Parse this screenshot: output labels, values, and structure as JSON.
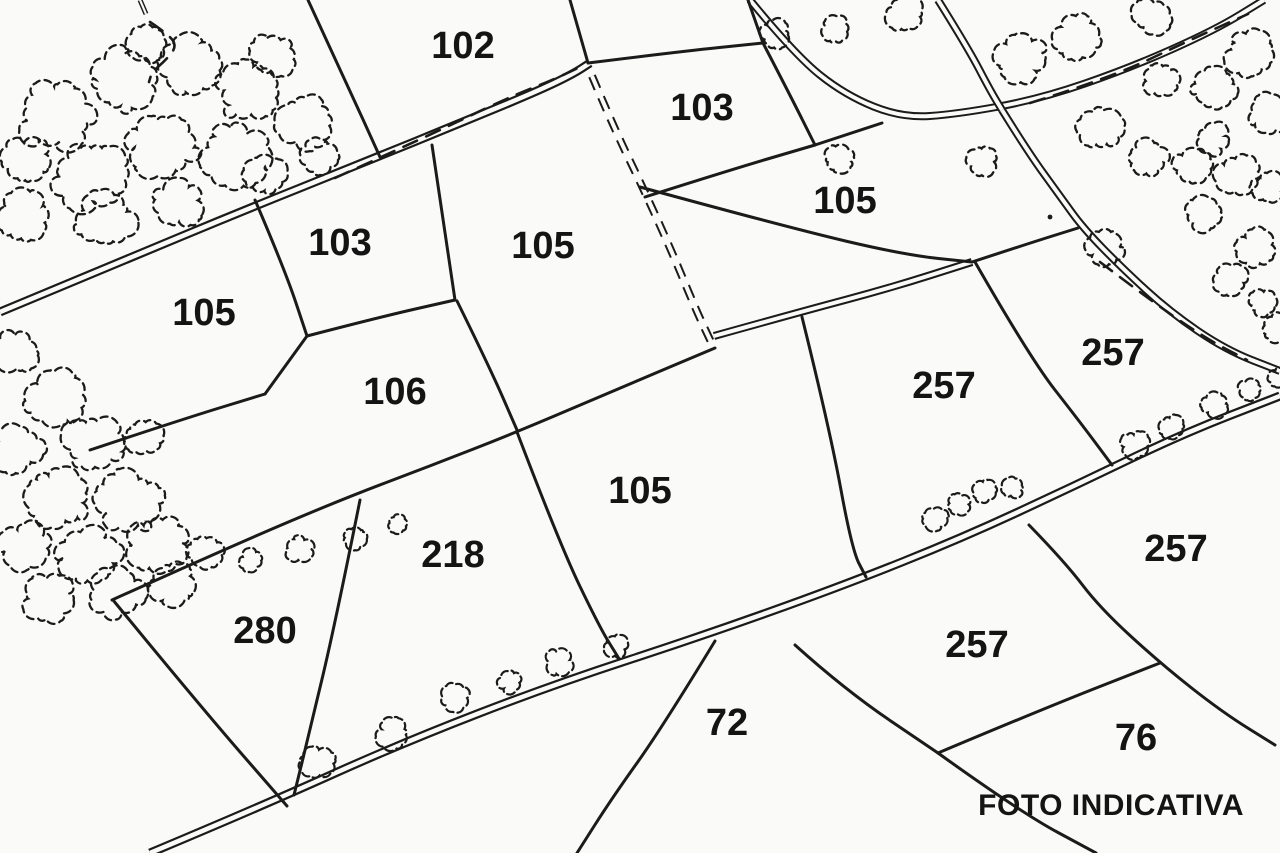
{
  "caption": {
    "text": "FOTO INDICATIVA",
    "x": 1245,
    "y": 822
  },
  "map": {
    "background": "#fafaf9",
    "ink": "#1b1b1b",
    "label_color": "#141414",
    "parcel_labels": [
      {
        "label": "102",
        "x": 463,
        "y": 45
      },
      {
        "label": "103",
        "x": 702,
        "y": 107
      },
      {
        "label": "105",
        "x": 845,
        "y": 200
      },
      {
        "label": "103",
        "x": 340,
        "y": 242
      },
      {
        "label": "105",
        "x": 543,
        "y": 245
      },
      {
        "label": "105",
        "x": 204,
        "y": 312
      },
      {
        "label": "257",
        "x": 1113,
        "y": 352
      },
      {
        "label": "257",
        "x": 944,
        "y": 385
      },
      {
        "label": "106",
        "x": 395,
        "y": 391
      },
      {
        "label": "105",
        "x": 640,
        "y": 490
      },
      {
        "label": "257",
        "x": 1176,
        "y": 548
      },
      {
        "label": "218",
        "x": 453,
        "y": 554
      },
      {
        "label": "280",
        "x": 265,
        "y": 630
      },
      {
        "label": "257",
        "x": 977,
        "y": 644
      },
      {
        "label": "72",
        "x": 727,
        "y": 722
      },
      {
        "label": "76",
        "x": 1136,
        "y": 737
      }
    ],
    "roads": [
      {
        "name": "road-upper-left",
        "outer": 9,
        "inner": 4.5,
        "points": [
          [
            0,
            312
          ],
          [
            120,
            262
          ],
          [
            240,
            212
          ],
          [
            360,
            164
          ],
          [
            468,
            120
          ],
          [
            540,
            90
          ],
          [
            573,
            74
          ],
          [
            590,
            63
          ]
        ]
      },
      {
        "name": "road-bottom",
        "outer": 9,
        "inner": 4.5,
        "points": [
          [
            150,
            853
          ],
          [
            262,
            806
          ],
          [
            402,
            743
          ],
          [
            552,
            685
          ],
          [
            702,
            636
          ],
          [
            842,
            586
          ],
          [
            962,
            538
          ],
          [
            1072,
            487
          ],
          [
            1182,
            434
          ],
          [
            1280,
            396
          ]
        ]
      },
      {
        "name": "road-top-branch",
        "outer": 8,
        "inner": 4,
        "points": [
          [
            750,
            0
          ],
          [
            795,
            55
          ],
          [
            845,
            95
          ],
          [
            902,
            118
          ],
          [
            958,
            114
          ],
          [
            1040,
            99
          ],
          [
            1130,
            68
          ],
          [
            1215,
            30
          ],
          [
            1264,
            0
          ]
        ]
      },
      {
        "name": "road-top-spur",
        "outer": 8,
        "inner": 4,
        "points": [
          [
            938,
            0
          ],
          [
            968,
            48
          ],
          [
            990,
            90
          ],
          [
            1002,
            110
          ]
        ]
      },
      {
        "name": "road-right",
        "outer": 8,
        "inner": 4,
        "points": [
          [
            1002,
            110
          ],
          [
            1028,
            152
          ],
          [
            1060,
            196
          ],
          [
            1083,
            228
          ],
          [
            1122,
            268
          ],
          [
            1170,
            312
          ],
          [
            1226,
            350
          ],
          [
            1280,
            371
          ]
        ]
      },
      {
        "name": "field-track-solid",
        "outer": 8,
        "inner": 4,
        "points": [
          [
            714,
            336
          ],
          [
            800,
            312
          ],
          [
            890,
            288
          ],
          [
            972,
            262
          ]
        ]
      },
      {
        "name": "path-stub-top-left",
        "outer": 5,
        "inner": 2.2,
        "points": [
          [
            140,
            0
          ],
          [
            146,
            14
          ]
        ]
      }
    ],
    "dashed_double_tracks": [
      {
        "name": "field-track-dashed",
        "points": [
          [
            592,
            76
          ],
          [
            614,
            128
          ],
          [
            644,
            190
          ],
          [
            672,
            252
          ],
          [
            696,
            310
          ],
          [
            712,
            344
          ]
        ]
      }
    ],
    "boundaries": [
      [
        [
          308,
          0
        ],
        [
          346,
          82
        ],
        [
          380,
          157
        ]
      ],
      [
        [
          570,
          0
        ],
        [
          588,
          63
        ]
      ],
      [
        [
          588,
          63
        ],
        [
          676,
          52
        ],
        [
          763,
          43
        ]
      ],
      [
        [
          748,
          0
        ],
        [
          763,
          43
        ]
      ],
      [
        [
          763,
          43
        ],
        [
          790,
          95
        ],
        [
          815,
          145
        ]
      ],
      [
        [
          645,
          197
        ],
        [
          730,
          170
        ],
        [
          815,
          145
        ]
      ],
      [
        [
          815,
          145
        ],
        [
          882,
          123
        ]
      ],
      [
        [
          640,
          187
        ],
        [
          790,
          228
        ],
        [
          905,
          255
        ],
        [
          972,
          262
        ]
      ],
      [
        [
          972,
          262
        ],
        [
          1030,
          243
        ],
        [
          1078,
          228
        ]
      ],
      [
        [
          255,
          200
        ],
        [
          285,
          270
        ],
        [
          307,
          336
        ]
      ],
      [
        [
          307,
          336
        ],
        [
          380,
          317
        ],
        [
          455,
          300
        ]
      ],
      [
        [
          432,
          145
        ],
        [
          455,
          300
        ]
      ],
      [
        [
          457,
          301
        ],
        [
          490,
          368
        ],
        [
          517,
          430
        ]
      ],
      [
        [
          90,
          450
        ],
        [
          180,
          420
        ],
        [
          265,
          394
        ]
      ],
      [
        [
          265,
          394
        ],
        [
          307,
          336
        ]
      ],
      [
        [
          112,
          600
        ],
        [
          225,
          549
        ],
        [
          340,
          500
        ],
        [
          430,
          466
        ],
        [
          517,
          432
        ],
        [
          620,
          388
        ],
        [
          715,
          348
        ]
      ],
      [
        [
          517,
          432
        ],
        [
          560,
          545
        ],
        [
          600,
          628
        ],
        [
          618,
          657
        ]
      ],
      [
        [
          360,
          500
        ],
        [
          336,
          620
        ],
        [
          310,
          730
        ],
        [
          294,
          795
        ]
      ],
      [
        [
          113,
          600
        ],
        [
          200,
          706
        ],
        [
          287,
          806
        ]
      ],
      [
        [
          802,
          317
        ],
        [
          830,
          430
        ],
        [
          852,
          550
        ],
        [
          866,
          577
        ]
      ],
      [
        [
          975,
          262
        ],
        [
          1030,
          358
        ],
        [
          1080,
          422
        ],
        [
          1112,
          465
        ]
      ],
      [
        [
          1029,
          525
        ],
        [
          1065,
          562
        ],
        [
          1100,
          608
        ],
        [
          1160,
          663
        ],
        [
          1222,
          712
        ],
        [
          1275,
          745
        ]
      ],
      [
        [
          795,
          645
        ],
        [
          845,
          690
        ],
        [
          938,
          753
        ]
      ],
      [
        [
          938,
          753
        ],
        [
          1045,
          708
        ],
        [
          1160,
          663
        ]
      ],
      [
        [
          938,
          753
        ],
        [
          1020,
          812
        ],
        [
          1096,
          853
        ]
      ],
      [
        [
          715,
          641
        ],
        [
          662,
          728
        ],
        [
          612,
          798
        ],
        [
          577,
          853
        ]
      ]
    ],
    "dashed_lines": [
      [
        [
          335,
          178
        ],
        [
          430,
          135
        ],
        [
          505,
          99
        ],
        [
          555,
          79
        ],
        [
          582,
          66
        ]
      ],
      [
        [
          1030,
          103
        ],
        [
          1110,
          78
        ],
        [
          1190,
          40
        ],
        [
          1248,
          14
        ]
      ],
      [
        [
          1100,
          262
        ],
        [
          1150,
          300
        ],
        [
          1205,
          338
        ],
        [
          1247,
          360
        ]
      ],
      [
        [
          150,
          22
        ],
        [
          168,
          34
        ],
        [
          177,
          46
        ],
        [
          166,
          60
        ],
        [
          152,
          72
        ],
        [
          149,
          82
        ]
      ]
    ],
    "trees": [
      [
        55,
        115,
        40
      ],
      [
        122,
        80,
        36
      ],
      [
        190,
        64,
        33
      ],
      [
        250,
        90,
        36
      ],
      [
        305,
        124,
        30
      ],
      [
        90,
        175,
        40
      ],
      [
        163,
        145,
        38
      ],
      [
        235,
        155,
        36
      ],
      [
        25,
        215,
        28
      ],
      [
        105,
        220,
        32
      ],
      [
        178,
        204,
        27
      ],
      [
        265,
        175,
        22
      ],
      [
        318,
        156,
        20
      ],
      [
        28,
        160,
        26
      ],
      [
        272,
        55,
        24
      ],
      [
        148,
        45,
        20
      ],
      [
        15,
        352,
        24
      ],
      [
        55,
        398,
        32
      ],
      [
        18,
        448,
        28
      ],
      [
        95,
        443,
        34
      ],
      [
        58,
        498,
        34
      ],
      [
        130,
        502,
        36
      ],
      [
        25,
        545,
        26
      ],
      [
        90,
        558,
        34
      ],
      [
        158,
        543,
        32
      ],
      [
        50,
        598,
        28
      ],
      [
        115,
        593,
        30
      ],
      [
        172,
        584,
        24
      ],
      [
        145,
        438,
        20
      ],
      [
        205,
        553,
        20
      ],
      [
        905,
        14,
        20
      ],
      [
        1020,
        58,
        28
      ],
      [
        1077,
        37,
        24
      ],
      [
        1152,
        16,
        20
      ],
      [
        1250,
        54,
        26
      ],
      [
        1215,
        89,
        24
      ],
      [
        1160,
        79,
        20
      ],
      [
        1270,
        114,
        22
      ],
      [
        1100,
        129,
        24
      ],
      [
        1147,
        159,
        22
      ],
      [
        1192,
        167,
        20
      ],
      [
        1237,
        174,
        22
      ],
      [
        1268,
        187,
        18
      ],
      [
        1213,
        139,
        18
      ],
      [
        840,
        159,
        16
      ],
      [
        982,
        161,
        16
      ],
      [
        775,
        34,
        16
      ],
      [
        836,
        30,
        15
      ],
      [
        1105,
        249,
        20
      ],
      [
        1255,
        249,
        22
      ],
      [
        1205,
        214,
        20
      ],
      [
        1278,
        328,
        16
      ],
      [
        1262,
        302,
        16
      ],
      [
        1230,
        280,
        18
      ]
    ],
    "bushes": [
      [
        318,
        762,
        19
      ],
      [
        393,
        733,
        17
      ],
      [
        455,
        697,
        16
      ],
      [
        510,
        682,
        13
      ],
      [
        558,
        662,
        15
      ],
      [
        616,
        646,
        13
      ],
      [
        937,
        518,
        14
      ],
      [
        960,
        504,
        12
      ],
      [
        984,
        492,
        13
      ],
      [
        1013,
        488,
        11
      ],
      [
        1135,
        445,
        15
      ],
      [
        1172,
        427,
        13
      ],
      [
        1215,
        405,
        15
      ],
      [
        1249,
        390,
        12
      ],
      [
        1278,
        377,
        11
      ],
      [
        252,
        560,
        13
      ],
      [
        300,
        549,
        15
      ],
      [
        355,
        538,
        13
      ],
      [
        398,
        524,
        11
      ]
    ],
    "dots": [
      [
        1050,
        217
      ]
    ]
  }
}
